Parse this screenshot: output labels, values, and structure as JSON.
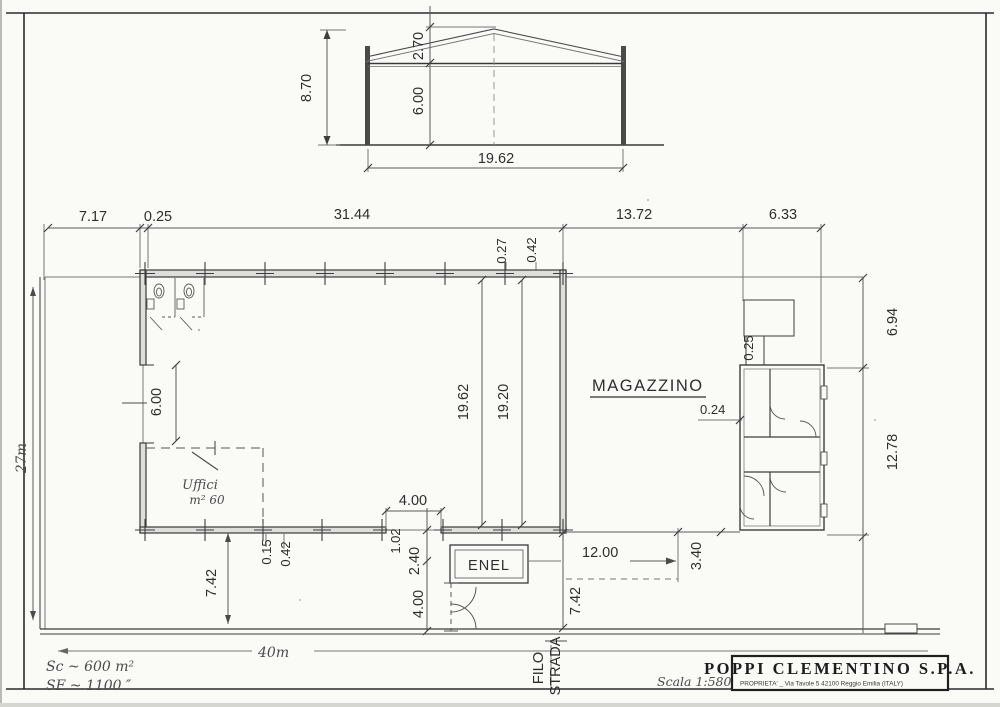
{
  "section": {
    "total_height": "8.70",
    "roof_rise": "2.70",
    "wall_height": "6.00",
    "width": "19.62"
  },
  "plan": {
    "top": {
      "left_offset": "7.17",
      "wall": "0.25",
      "building_width": "31.44",
      "yard": "13.72",
      "annex_width": "6.33"
    },
    "top_wall": {
      "t1": "0.27",
      "t2": "0.42"
    },
    "left": {
      "boundary": "27m",
      "door": "6.00"
    },
    "interior": {
      "room": "MAGAZZINO",
      "depth1": "19.62",
      "depth2": "19.20"
    },
    "office": {
      "name": "Uffici",
      "area": "m² 60"
    },
    "right": {
      "gap": "6.94",
      "annex_depth": "12.78",
      "wall1": "0.25",
      "wall2": "0.24"
    },
    "bottom": {
      "wt1": "0.15",
      "wt2": "0.42",
      "opening": "4.00",
      "s1": "1.02",
      "s2": "2.40",
      "s3": "4.00",
      "setback_left": "7.42",
      "setback_right": "7.42",
      "yard": "12.00",
      "gap": "3.40",
      "cabinet": "ENEL",
      "frontage": "40m"
    },
    "street": {
      "filo": "FILO",
      "strada": "STRADA"
    }
  },
  "notes": {
    "sc": "Sc ~ 600 m²",
    "sf": "SF ~ 1100 ″",
    "scale": "Scala 1:580"
  },
  "title_block": {
    "company": "POPPI  CLEMENTINO  S.P.A.",
    "address": "PROPRIETA'  _  Via Tavole 5   42100 Reggio Emilia (ITALY)"
  }
}
